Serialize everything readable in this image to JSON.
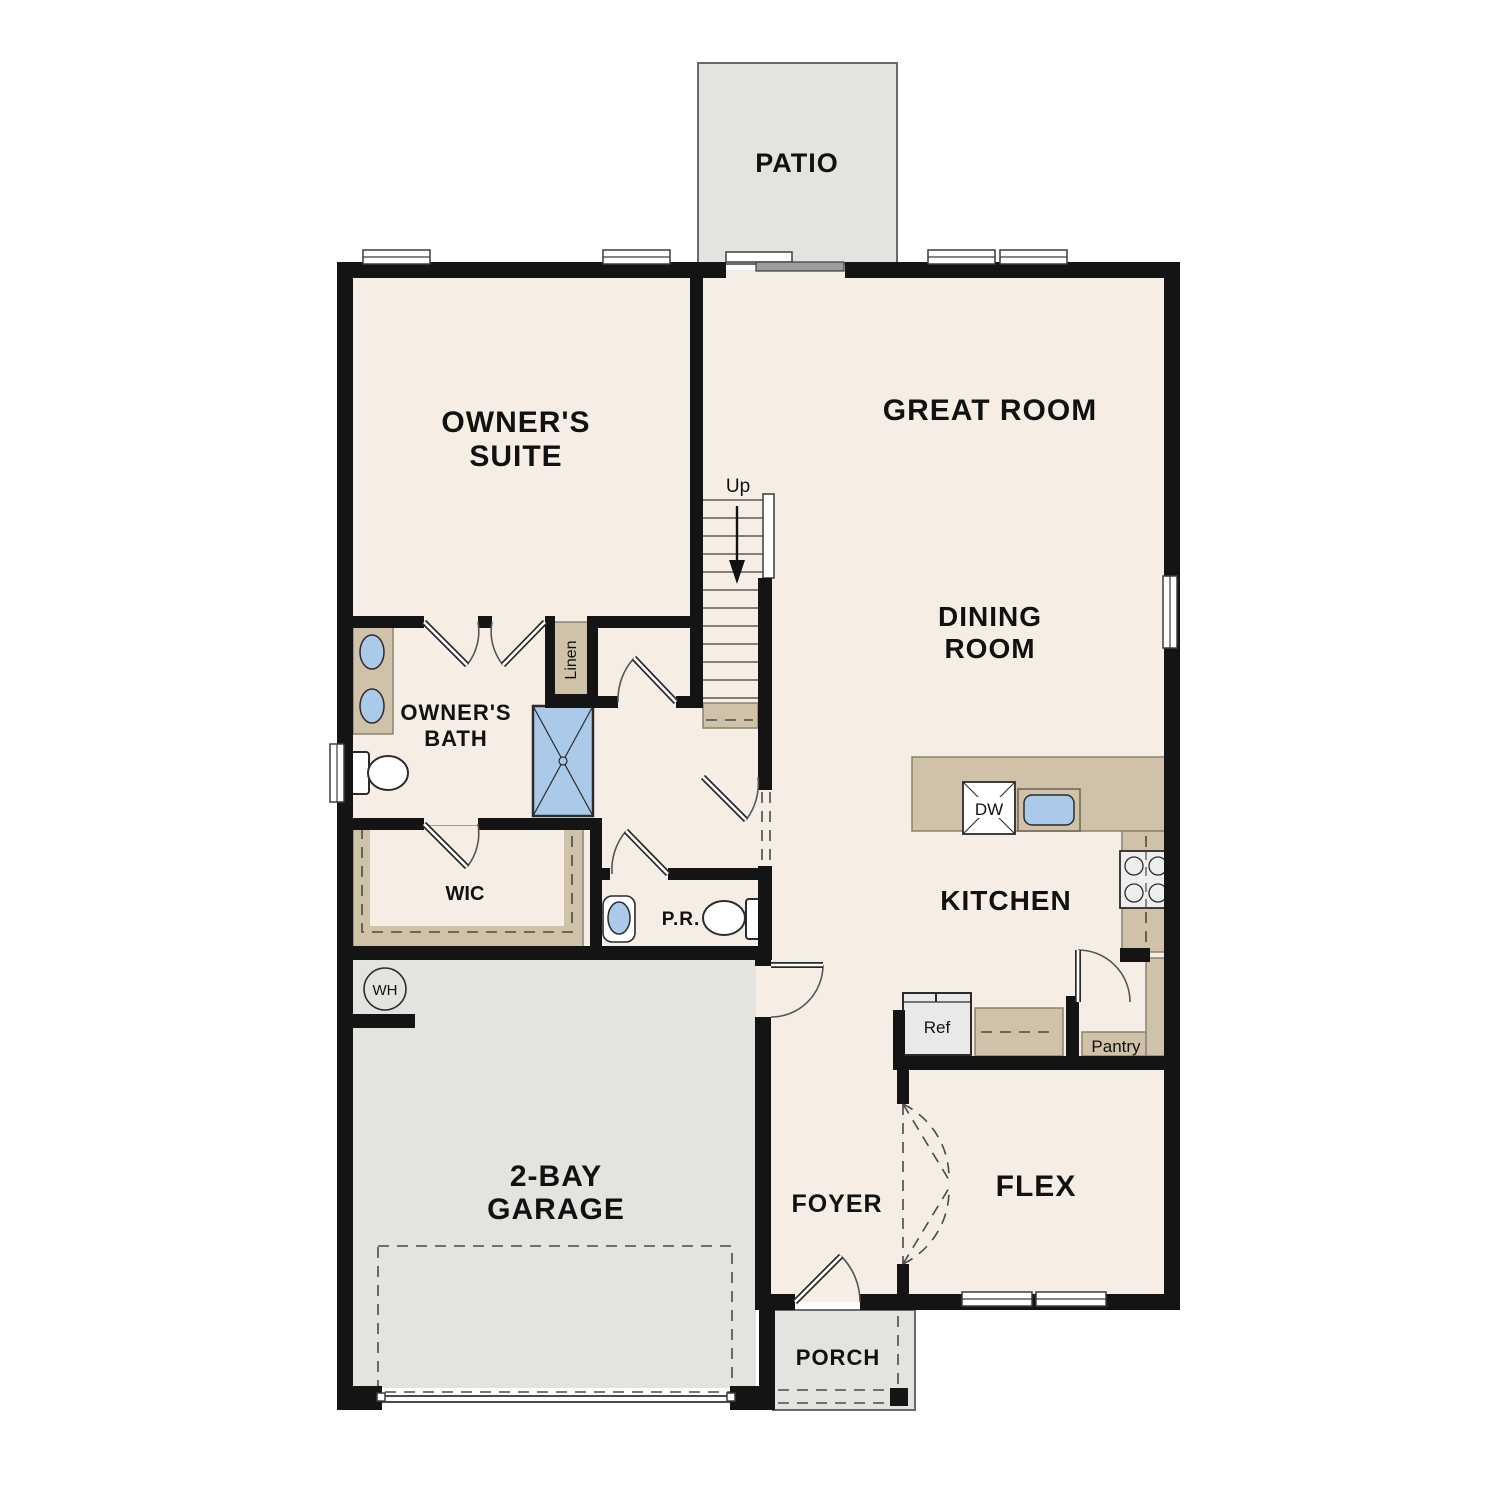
{
  "plan": {
    "rooms": {
      "patio": {
        "label": "PATIO"
      },
      "owners_suite": {
        "line1": "OWNER'S",
        "line2": "SUITE"
      },
      "great_room": {
        "label": "GREAT ROOM"
      },
      "dining_room": {
        "line1": "DINING",
        "line2": "ROOM"
      },
      "owners_bath": {
        "line1": "OWNER'S",
        "line2": "BATH"
      },
      "linen": {
        "label": "Linen"
      },
      "wic": {
        "label": "WIC"
      },
      "powder_room": {
        "label": "P.R."
      },
      "kitchen": {
        "label": "KITCHEN"
      },
      "pantry": {
        "label": "Pantry"
      },
      "garage": {
        "line1": "2-BAY",
        "line2": "GARAGE"
      },
      "foyer": {
        "label": "FOYER"
      },
      "flex": {
        "label": "FLEX"
      },
      "porch": {
        "label": "PORCH"
      }
    },
    "stairs": {
      "direction_label": "Up"
    },
    "appliances": {
      "dishwasher": "DW",
      "refrigerator": "Ref",
      "water_heater": "WH"
    },
    "colors": {
      "floor": "#f6eee4",
      "hard_surface": "#e4e3e0",
      "cabinetry": "#cfc2a9",
      "wall": "#141414",
      "fixture_blue": "#abc9e9"
    }
  }
}
